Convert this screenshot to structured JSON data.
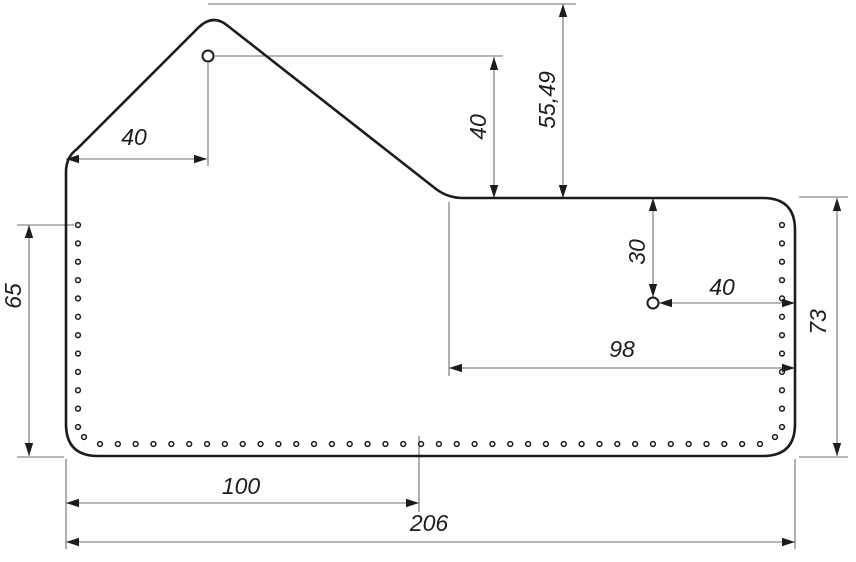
{
  "canvas": {
    "width": 856,
    "height": 562
  },
  "styles": {
    "background": "#ffffff",
    "outline_color": "#1c1c1c",
    "dimension_line_color": "#6e6e6e",
    "text_color": "#1c1c1c"
  },
  "part": {
    "description": "flat pattern outline with peaked flap, two rivet holes and perimeter stitch holes",
    "outline_path": "M 66 172 Q 66 157 77 149 L 198 28 Q 213 13 228 26 L 436 189 Q 448 198 463 198 L 763 198 Q 795 198 795 230 L 795 424 Q 795 456 763 456 L 98 456 Q 66 456 66 424 Z",
    "rivet_holes": [
      {
        "cx": 208,
        "cy": 56,
        "r": 5.5
      },
      {
        "cx": 653,
        "cy": 303,
        "r": 5.5
      }
    ],
    "stitch_hole_radius": 2.4,
    "stitch_rows": [
      {
        "name": "left-column",
        "x1": 78,
        "y1": 225,
        "x2": 78,
        "y2": 427,
        "count": 12
      },
      {
        "name": "bottom-row",
        "x1": 100,
        "y1": 444,
        "x2": 760,
        "y2": 444,
        "count": 38
      },
      {
        "name": "right-column",
        "x1": 782,
        "y1": 225,
        "x2": 782,
        "y2": 427,
        "count": 12
      },
      {
        "name": "corner-left",
        "x1": 84,
        "y1": 437,
        "x2": 84,
        "y2": 437,
        "count": 1
      },
      {
        "name": "corner-right",
        "x1": 775,
        "y1": 437,
        "x2": 775,
        "y2": 437,
        "count": 1
      }
    ]
  },
  "dimensions": [
    {
      "label": "40",
      "orientation": "horizontal",
      "line": [
        66,
        159,
        207,
        159
      ],
      "extensions": [
        [
          208,
          63,
          208,
          166
        ]
      ],
      "text": [
        134,
        137
      ]
    },
    {
      "label": "40",
      "orientation": "vertical",
      "line": [
        494,
        57,
        494,
        198
      ],
      "extensions": [
        [
          215,
          56,
          503,
          56
        ]
      ],
      "text": [
        478,
        127
      ]
    },
    {
      "label": "55,49",
      "orientation": "vertical",
      "line": [
        563,
        4,
        563,
        198
      ],
      "extensions": [
        [
          208,
          4,
          576,
          4
        ]
      ],
      "text": [
        547,
        100
      ]
    },
    {
      "label": "65",
      "orientation": "vertical",
      "line": [
        29,
        225,
        29,
        456
      ],
      "extensions": [
        [
          17,
          225,
          74,
          225
        ],
        [
          17,
          457,
          64,
          457
        ]
      ],
      "text": [
        13,
        296
      ]
    },
    {
      "label": "30",
      "orientation": "vertical",
      "line": [
        653,
        198,
        653,
        297
      ],
      "extensions": [],
      "text": [
        637,
        252
      ]
    },
    {
      "label": "40",
      "orientation": "horizontal",
      "line": [
        659,
        303,
        795,
        303
      ],
      "extensions": [],
      "text": [
        722,
        287
      ]
    },
    {
      "label": "98",
      "orientation": "horizontal",
      "line": [
        449,
        368,
        795,
        368
      ],
      "extensions": [
        [
          449,
          202,
          449,
          376
        ]
      ],
      "text": [
        622,
        349
      ]
    },
    {
      "label": "73",
      "orientation": "vertical",
      "line": [
        837,
        198,
        837,
        456
      ],
      "extensions": [
        [
          799,
          197,
          848,
          197
        ],
        [
          799,
          457,
          848,
          457
        ]
      ],
      "text": [
        818,
        322
      ]
    },
    {
      "label": "100",
      "orientation": "horizontal",
      "line": [
        66,
        503,
        419,
        503
      ],
      "extensions": [
        [
          419,
          436,
          419,
          512
        ]
      ],
      "text": [
        241,
        486
      ]
    },
    {
      "label": "206",
      "orientation": "horizontal",
      "line": [
        66,
        542,
        795,
        542
      ],
      "extensions": [
        [
          66,
          459,
          66,
          549
        ],
        [
          795,
          459,
          795,
          549
        ]
      ],
      "text": [
        429,
        523
      ]
    }
  ]
}
